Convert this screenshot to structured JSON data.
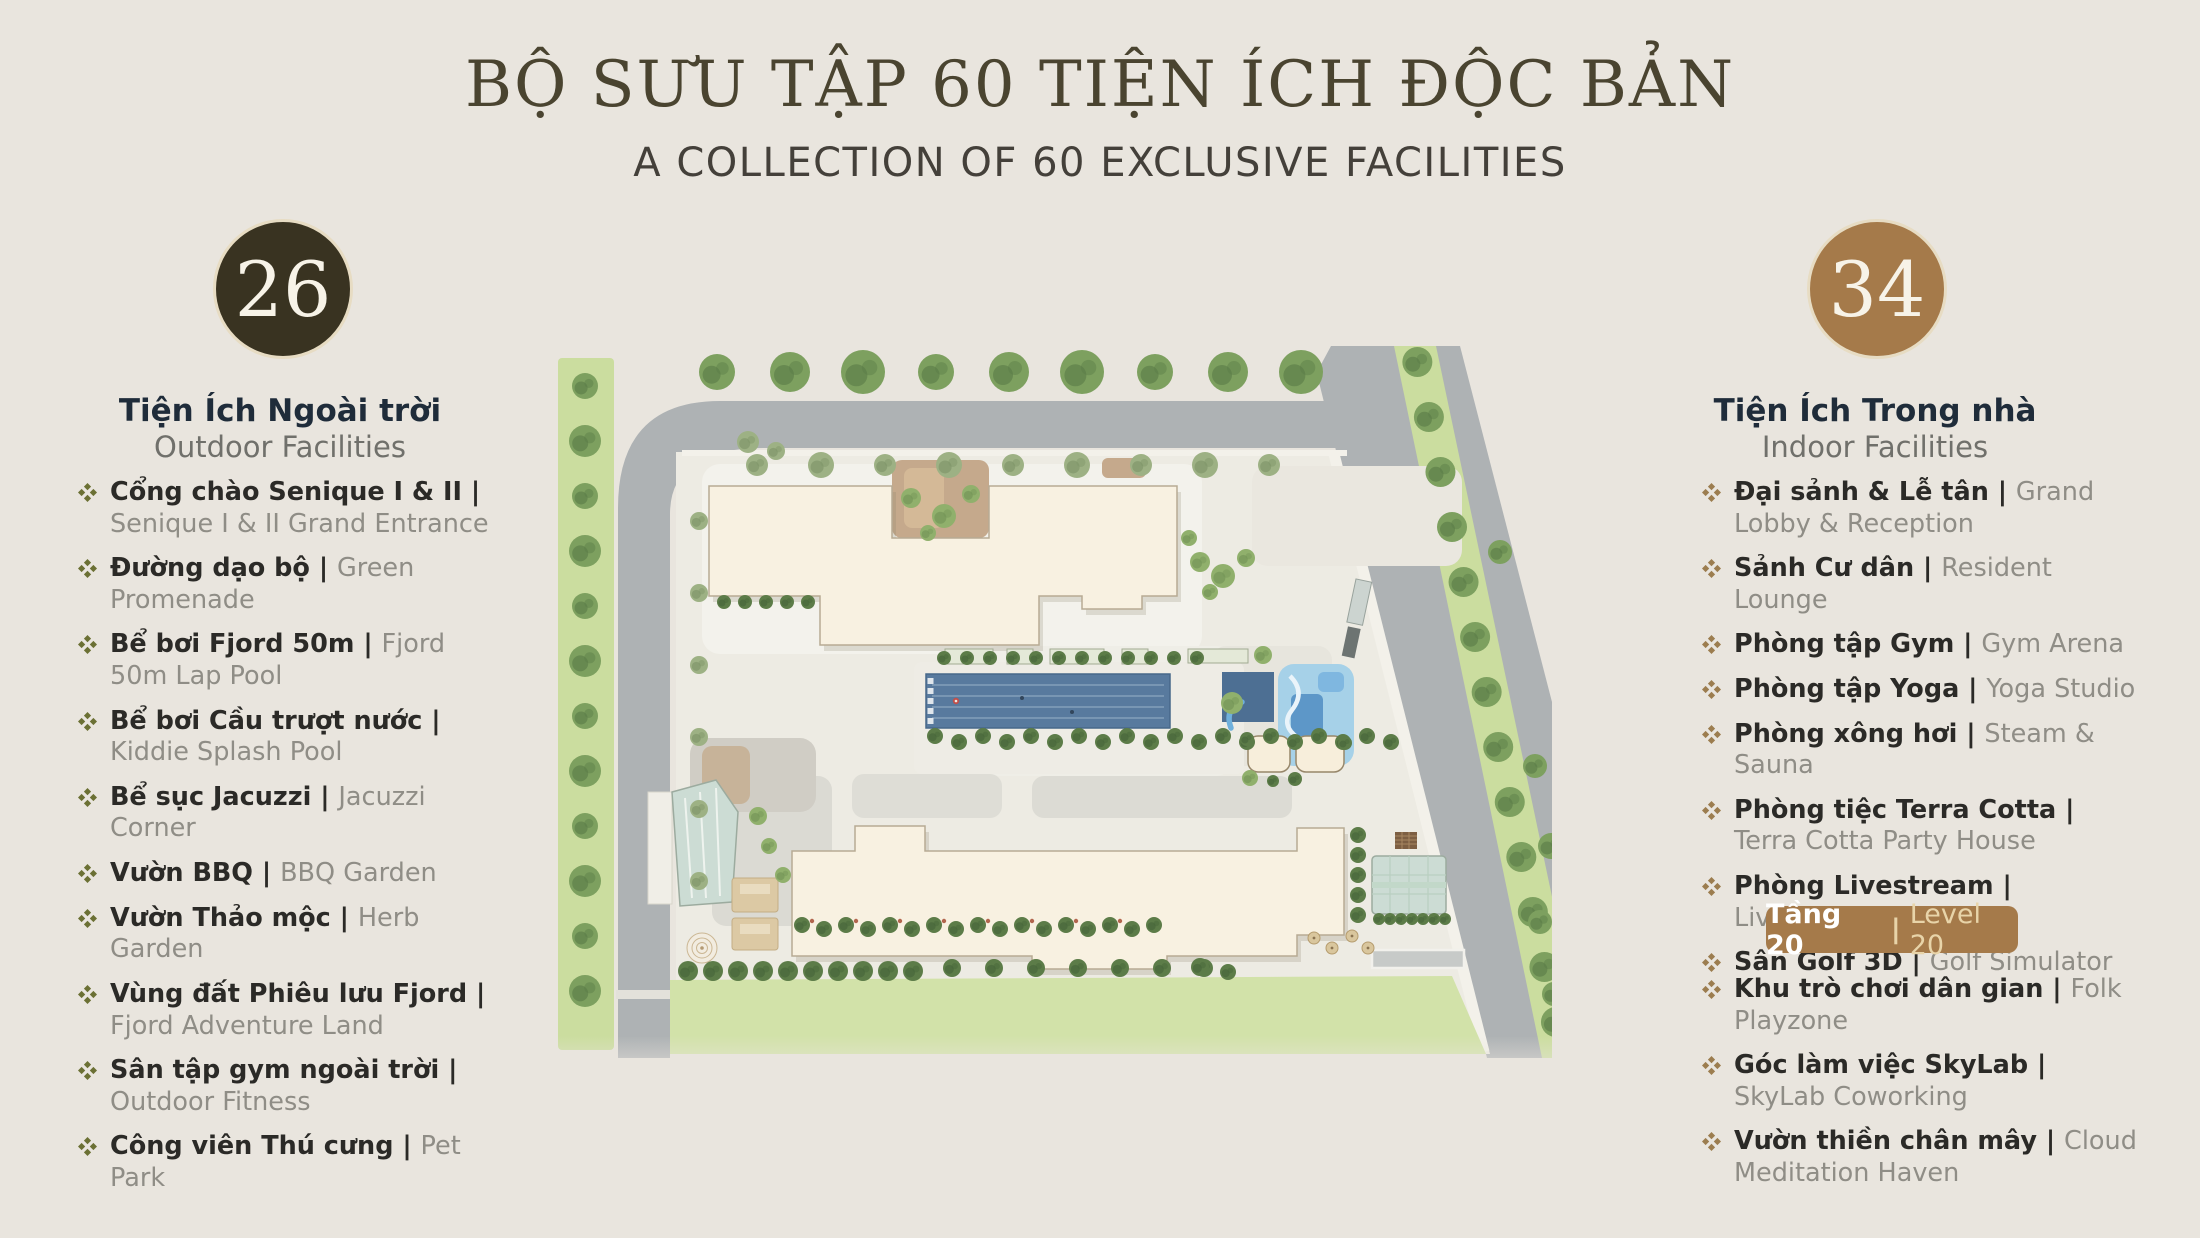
{
  "header": {
    "title_vi": "BỘ SƯU TẬP 60 TIỆN ÍCH ĐỘC BẢN",
    "title_en": "A COLLECTION OF 60 EXCLUSIVE FACILITIES"
  },
  "outdoor": {
    "count": "26",
    "heading_vi": "Tiện Ích Ngoài trời",
    "heading_en": "Outdoor Facilities",
    "separator": "|",
    "items": [
      {
        "vi": "Cổng chào Senique I & II",
        "en": "Senique I & II Grand Entrance"
      },
      {
        "vi": "Đường dạo bộ",
        "en": "Green Promenade"
      },
      {
        "vi": "Bể bơi Fjord 50m",
        "en": "Fjord 50m Lap Pool"
      },
      {
        "vi": "Bể bơi Cầu trượt nước",
        "en": "Kiddie Splash Pool"
      },
      {
        "vi": "Bể sục Jacuzzi",
        "en": "Jacuzzi Corner"
      },
      {
        "vi": "Vườn BBQ",
        "en": "BBQ Garden"
      },
      {
        "vi": "Vườn Thảo mộc",
        "en": "Herb Garden"
      },
      {
        "vi": "Vùng đất Phiêu lưu Fjord",
        "en": "Fjord Adventure Land"
      },
      {
        "vi": "Sân tập gym ngoài trời",
        "en": "Outdoor Fitness"
      },
      {
        "vi": "Công viên Thú cưng",
        "en": "Pet Park"
      }
    ]
  },
  "indoor": {
    "count": "34",
    "heading_vi": "Tiện Ích Trong nhà",
    "heading_en": "Indoor Facilities",
    "separator": "|",
    "items": [
      {
        "vi": "Đại sảnh & Lễ tân",
        "en": "Grand Lobby & Reception"
      },
      {
        "vi": "Sảnh Cư dân",
        "en": "Resident Lounge"
      },
      {
        "vi": "Phòng tập Gym",
        "en": "Gym Arena"
      },
      {
        "vi": "Phòng tập Yoga",
        "en": "Yoga Studio"
      },
      {
        "vi": "Phòng xông hơi",
        "en": "Steam & Sauna"
      },
      {
        "vi": "Phòng tiệc Terra Cotta",
        "en": "Terra Cotta Party House"
      },
      {
        "vi": "Phòng Livestream",
        "en": "Livestream studio"
      },
      {
        "vi": "Sân Golf 3D",
        "en": "Golf Simulator"
      }
    ],
    "badge": {
      "vi": "Tầng 20",
      "en": "Level 20"
    },
    "level_items": [
      {
        "vi": "Khu trò chơi dân gian",
        "en": "Folk Playzone"
      },
      {
        "vi": "Góc làm việc SkyLab",
        "en": "SkyLab Coworking"
      },
      {
        "vi": "Vườn thiền chân mây",
        "en": "Cloud Meditation Haven"
      }
    ]
  },
  "colors": {
    "background": "#e9e5de",
    "title": "#4a4430",
    "subtitle": "#44403a",
    "heading_vi": "#1f2c3a",
    "heading_en": "#70706b",
    "item_vi": "#2b2a27",
    "item_en": "#8f8d86",
    "bullet_outdoor": "#6b7034",
    "bullet_indoor": "#9c7d4f",
    "circle_outdoor": "#393321",
    "circle_indoor": "#a57a4a",
    "circle_ring": "#e7dcc3",
    "circle_number": "#f7f3e8",
    "badge_bg": "#a57a4a",
    "badge_vi": "#ffffff",
    "badge_en": "#e8d4a9"
  },
  "map_colors": {
    "road": "#aeb2b4",
    "grass": "#cbdd9f",
    "site": "#edebe3",
    "building": "#f8f1e1",
    "lawn": "#d2e2a9",
    "pool": "#587a9e",
    "pool_deep": "#4d6f93",
    "kiddie": "#a6d1e8",
    "tan": "#c5a98c",
    "glass": "#ccdcd4",
    "tree": "#7da05f",
    "tree_dark": "#5c7c48",
    "tree_sage": "#9db184",
    "tree_light": "#90b06c"
  }
}
